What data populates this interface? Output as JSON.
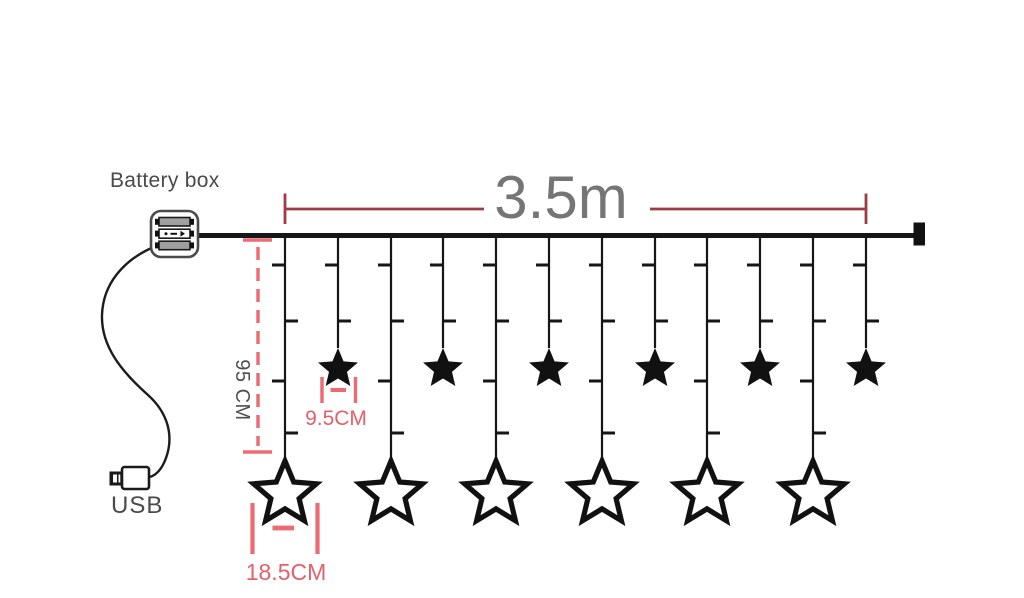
{
  "labels": {
    "battery_box": "Battery box",
    "usb": "USB",
    "total_length": "3.5m",
    "drop_length": "95 CM",
    "small_star_width": "9.5CM",
    "big_star_width": "18.5CM"
  },
  "colors": {
    "background": "#ffffff",
    "wire": "#161616",
    "dimension_dark_red": "#9e3c44",
    "dimension_pink": "#ec6a72",
    "label_gray": "#4a4a4a",
    "length_text_gray": "#757575"
  },
  "diagram": {
    "total_strings": 12,
    "big_star_count": 6,
    "small_star_count": 6,
    "strings": [
      {
        "x": 285,
        "star": "big"
      },
      {
        "x": 338,
        "star": "small"
      },
      {
        "x": 391,
        "star": "big"
      },
      {
        "x": 443,
        "star": "small"
      },
      {
        "x": 496,
        "star": "big"
      },
      {
        "x": 549,
        "star": "small"
      },
      {
        "x": 602,
        "star": "big"
      },
      {
        "x": 655,
        "star": "small"
      },
      {
        "x": 707,
        "star": "big"
      },
      {
        "x": 760,
        "star": "small"
      },
      {
        "x": 813,
        "star": "big"
      },
      {
        "x": 866,
        "star": "small"
      }
    ]
  }
}
